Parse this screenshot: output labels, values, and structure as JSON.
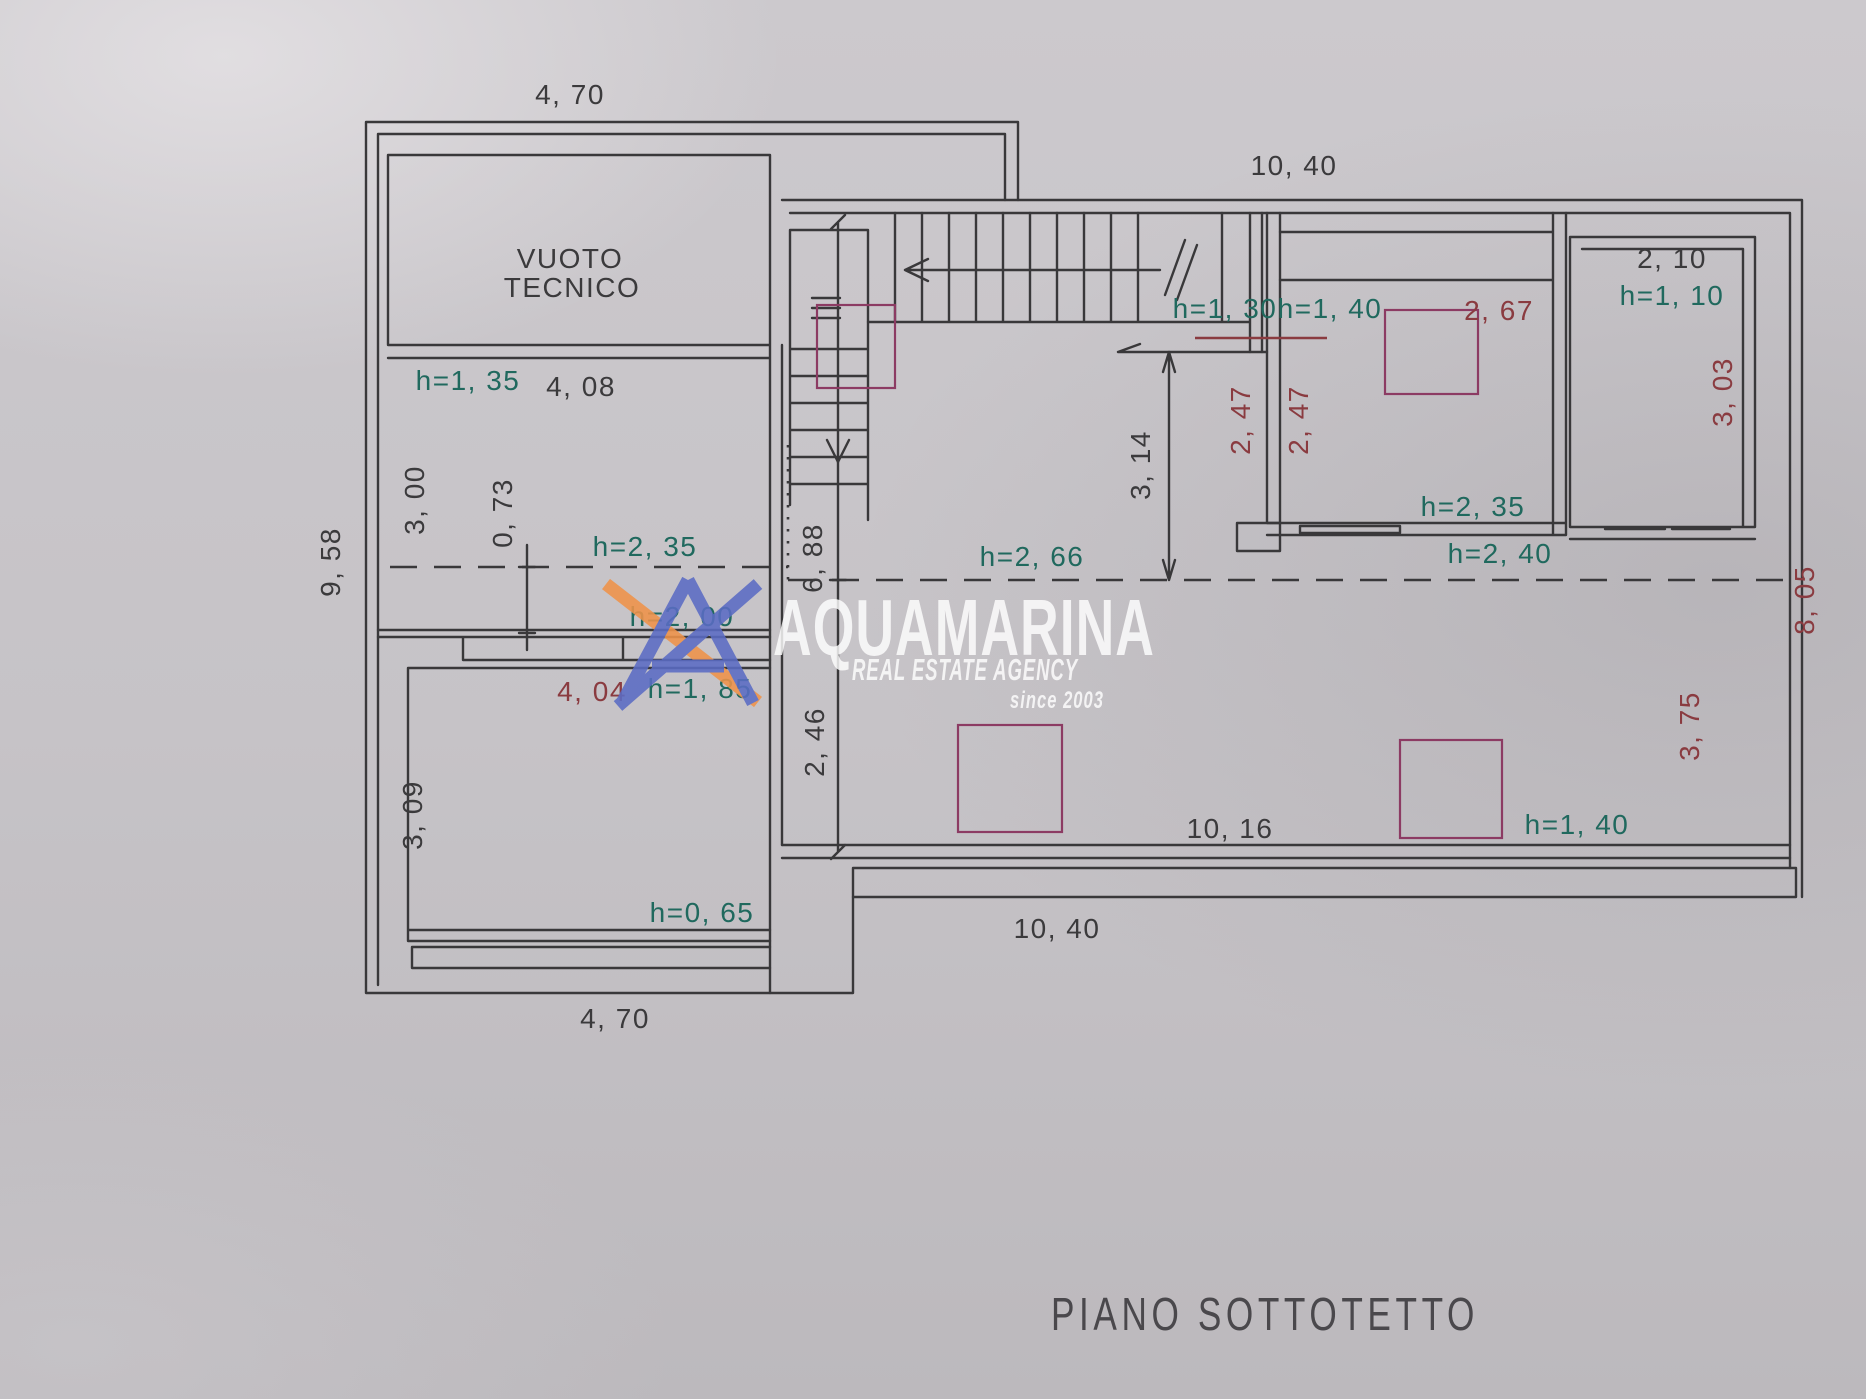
{
  "page": {
    "floor_title": "PIANO SOTTOTETTO"
  },
  "watermark": {
    "brand": "AQUAMARINA",
    "tagline": "REAL ESTATE AGENCY",
    "since": "since 2003"
  },
  "colors": {
    "ink": "#3b3a3c",
    "height_label": "#20695e",
    "dim_red": "#8a3b40",
    "skylight": "#8c3b63",
    "logo_blue": "#5b6cc4",
    "logo_orange": "#ef9349"
  },
  "plan": {
    "room_label": {
      "line1": "VUOTO",
      "line2": "TECNICO"
    },
    "labels": [
      {
        "name": "dim-top-left-width",
        "t": "4, 70",
        "x": 570,
        "y": 104,
        "c": "ink"
      },
      {
        "name": "dim-top-right-width",
        "t": "10, 40",
        "x": 1294,
        "y": 175,
        "c": "ink"
      },
      {
        "name": "room-vuoto-line1",
        "t": "VUOTO",
        "x": 570,
        "y": 268,
        "c": "ink",
        "fs": 26
      },
      {
        "name": "room-vuoto-line2",
        "t": "TECNICO",
        "x": 572,
        "y": 297,
        "c": "ink",
        "fs": 26
      },
      {
        "name": "h-135",
        "t": "h=1, 35",
        "x": 468,
        "y": 390,
        "c": "teal"
      },
      {
        "name": "dim-408",
        "t": "4, 08",
        "x": 581,
        "y": 396,
        "c": "ink"
      },
      {
        "name": "dim-300",
        "t": "3, 00",
        "x": 424,
        "y": 500,
        "c": "ink",
        "r": -90
      },
      {
        "name": "dim-073",
        "t": "0, 73",
        "x": 512,
        "y": 513,
        "c": "ink",
        "r": -90
      },
      {
        "name": "dim-958",
        "t": "9, 58",
        "x": 340,
        "y": 562,
        "c": "ink",
        "r": -90
      },
      {
        "name": "h-235-left",
        "t": "h=2, 35",
        "x": 645,
        "y": 556,
        "c": "teal"
      },
      {
        "name": "h-200",
        "t": "h=2, 00",
        "x": 682,
        "y": 626,
        "c": "teal"
      },
      {
        "name": "dim-404",
        "t": "4, 04",
        "x": 592,
        "y": 701,
        "c": "red"
      },
      {
        "name": "h-185",
        "t": "h=1, 85",
        "x": 700,
        "y": 698,
        "c": "teal"
      },
      {
        "name": "dim-309",
        "t": "3, 09",
        "x": 422,
        "y": 815,
        "c": "ink",
        "r": -90
      },
      {
        "name": "h-065",
        "t": "h=0, 65",
        "x": 702,
        "y": 922,
        "c": "teal"
      },
      {
        "name": "dim-bottom-left-width",
        "t": "4, 70",
        "x": 615,
        "y": 1028,
        "c": "ink"
      },
      {
        "name": "dim-688",
        "t": "6, 88",
        "x": 822,
        "y": 558,
        "c": "ink",
        "r": -90
      },
      {
        "name": "dim-246",
        "t": "2, 46",
        "x": 824,
        "y": 742,
        "c": "ink",
        "r": -90
      },
      {
        "name": "h-130",
        "t": "h=1, 30",
        "x": 1225,
        "y": 318,
        "c": "teal"
      },
      {
        "name": "h-140-top",
        "t": "h=1, 40",
        "x": 1330,
        "y": 318,
        "c": "teal"
      },
      {
        "name": "dim-267",
        "t": "2, 67",
        "x": 1499,
        "y": 320,
        "c": "red"
      },
      {
        "name": "dim-314",
        "t": "3, 14",
        "x": 1150,
        "y": 465,
        "c": "ink",
        "r": -90
      },
      {
        "name": "dim-247-left",
        "t": "2, 47",
        "x": 1250,
        "y": 420,
        "c": "red",
        "r": -90
      },
      {
        "name": "dim-247-right",
        "t": "2, 47",
        "x": 1308,
        "y": 420,
        "c": "red",
        "r": -90
      },
      {
        "name": "dim-210",
        "t": "2, 10",
        "x": 1672,
        "y": 268,
        "c": "ink"
      },
      {
        "name": "h-110",
        "t": "h=1, 10",
        "x": 1672,
        "y": 305,
        "c": "teal"
      },
      {
        "name": "dim-303",
        "t": "3, 03",
        "x": 1732,
        "y": 392,
        "c": "red",
        "r": -90
      },
      {
        "name": "h-235-right",
        "t": "h=2, 35",
        "x": 1473,
        "y": 516,
        "c": "teal"
      },
      {
        "name": "h-240",
        "t": "h=2, 40",
        "x": 1500,
        "y": 563,
        "c": "teal"
      },
      {
        "name": "h-266",
        "t": "h=2, 66",
        "x": 1032,
        "y": 566,
        "c": "teal"
      },
      {
        "name": "dim-805",
        "t": "8, 05",
        "x": 1814,
        "y": 600,
        "c": "red",
        "r": -90
      },
      {
        "name": "dim-375",
        "t": "3, 75",
        "x": 1699,
        "y": 726,
        "c": "red",
        "r": -90
      },
      {
        "name": "dim-1016",
        "t": "10, 16",
        "x": 1230,
        "y": 838,
        "c": "ink"
      },
      {
        "name": "h-140-bottom",
        "t": "h=1, 40",
        "x": 1577,
        "y": 834,
        "c": "teal"
      },
      {
        "name": "dim-bottom-right-width",
        "t": "10, 40",
        "x": 1057,
        "y": 938,
        "c": "ink"
      }
    ]
  }
}
